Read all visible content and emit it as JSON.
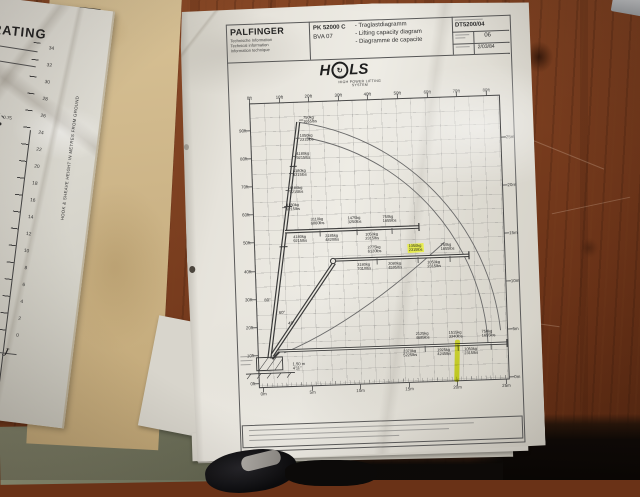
{
  "left_document": {
    "title": "RATING",
    "vertical_axis_label": "HOOK & SHEAVE HEIGHT IN METRES FROM GROUND",
    "axis_numbers": [
      {
        "y": 44,
        "label": "34"
      },
      {
        "y": 61,
        "label": "32"
      },
      {
        "y": 78,
        "label": "30"
      },
      {
        "y": 95,
        "label": "28"
      },
      {
        "y": 112,
        "label": "26"
      },
      {
        "y": 129,
        "label": "24"
      },
      {
        "y": 146,
        "label": "22"
      },
      {
        "y": 163,
        "label": "20"
      },
      {
        "y": 180,
        "label": "18"
      },
      {
        "y": 197,
        "label": "16"
      },
      {
        "y": 214,
        "label": "14"
      },
      {
        "y": 231,
        "label": "12"
      },
      {
        "y": 248,
        "label": "10"
      },
      {
        "y": 265,
        "label": "8"
      },
      {
        "y": 282,
        "label": "6"
      },
      {
        "y": 299,
        "label": "4"
      },
      {
        "y": 316,
        "label": "2"
      },
      {
        "y": 333,
        "label": "0"
      }
    ],
    "point_values": [
      {
        "x": 30,
        "y": 116,
        "label": "0.75"
      },
      {
        "x": 12,
        "y": 190,
        "label": "0.50"
      }
    ],
    "note_fragments": [
      {
        "x": 2,
        "y": 297,
        "label": "t obtained"
      },
      {
        "x": 0,
        "y": 305,
        "label": "y chart is the"
      },
      {
        "x": 0,
        "y": 313,
        "label": "to procure a"
      }
    ],
    "reference": "-1977/6/84",
    "signature": "J"
  },
  "main_document": {
    "header": {
      "brand": "PALFINGER",
      "brand_sub1": "Technische Information",
      "brand_sub2": "Technical information",
      "brand_sub3": "Information technique",
      "model": "PK 52000 C",
      "variant": "BVA 07",
      "title_de": "- Traglastdiagramm",
      "title_en": "- Lifting capacity diagram",
      "title_fr": "- Diagramme de capacite",
      "doc_number": "DT5200/04",
      "sheet_number": "06",
      "issue_date": "2/03/84"
    },
    "logo": {
      "h": "H",
      "ls": "LS",
      "circle_glyph": "↻",
      "max": "MAX",
      "tagline": "HIGH POWER LIFTING SYSTEM"
    },
    "chart": {
      "axes": {
        "top_ft": [
          {
            "x": 68,
            "label": "0ft"
          },
          {
            "x": 98,
            "label": "10ft"
          },
          {
            "x": 127,
            "label": "20ft"
          },
          {
            "x": 157,
            "label": "30ft"
          },
          {
            "x": 186,
            "label": "40ft"
          },
          {
            "x": 216,
            "label": "50ft"
          },
          {
            "x": 246,
            "label": "60ft"
          },
          {
            "x": 275,
            "label": "70ft"
          },
          {
            "x": 305,
            "label": "80ft"
          }
        ],
        "left_ft": [
          {
            "y": 123,
            "label": "90ft"
          },
          {
            "y": 151,
            "label": "80ft"
          },
          {
            "y": 179,
            "label": "70ft"
          },
          {
            "y": 207,
            "label": "60ft"
          },
          {
            "y": 235,
            "label": "50ft"
          },
          {
            "y": 264,
            "label": "40ft"
          },
          {
            "y": 292,
            "label": "30ft"
          },
          {
            "y": 320,
            "label": "20ft"
          },
          {
            "y": 348,
            "label": "10ft"
          },
          {
            "y": 376,
            "label": "0ft"
          }
        ],
        "right_m": [
          {
            "y": 138,
            "label": "25m"
          },
          {
            "y": 186,
            "label": "20m"
          },
          {
            "y": 234,
            "label": "15m"
          },
          {
            "y": 282,
            "label": "10m"
          },
          {
            "y": 330,
            "label": "5m"
          },
          {
            "y": 378,
            "label": "0m"
          }
        ],
        "bottom_m": [
          {
            "x": 72,
            "label": "0m"
          },
          {
            "x": 121,
            "label": "5m"
          },
          {
            "x": 169,
            "label": "10m"
          },
          {
            "x": 218,
            "label": "15m"
          },
          {
            "x": 266,
            "label": "20m"
          },
          {
            "x": 315,
            "label": "25m"
          }
        ]
      },
      "mast_labels": [
        {
          "x": 121,
          "y": 110,
          "kg": "750kg",
          "lbs": "1655lbs"
        },
        {
          "x": 117,
          "y": 128,
          "kg": "1050kg",
          "lbs": "2315lbs"
        },
        {
          "x": 113,
          "y": 146,
          "kg": "4180kg",
          "lbs": "9215lbs"
        },
        {
          "x": 109,
          "y": 163,
          "kg": "4180kg",
          "lbs": "9215lbs"
        },
        {
          "x": 105,
          "y": 180,
          "kg": "4180kg",
          "lbs": "9215lbs"
        },
        {
          "x": 101,
          "y": 197,
          "kg": "4180kg",
          "lbs": "9215lbs"
        }
      ],
      "boom1_above": [
        {
          "x": 125,
          "y": 212,
          "kg": "3110kg",
          "lbs": "6860lbs"
        },
        {
          "x": 162,
          "y": 212,
          "kg": "1475kg",
          "lbs": "3250lbs"
        },
        {
          "x": 197,
          "y": 212,
          "kg": "750kg",
          "lbs": "1655lbs"
        }
      ],
      "boom1_below": [
        {
          "x": 107,
          "y": 229,
          "kg": "4180kg",
          "lbs": "9215lbs"
        },
        {
          "x": 139,
          "y": 229,
          "kg": "2185kg",
          "lbs": "4820lbs"
        },
        {
          "x": 179,
          "y": 229,
          "kg": "1050kg",
          "lbs": "2315lbs"
        }
      ],
      "boom2_above": [
        {
          "x": 181,
          "y": 242,
          "kg": "2775kg",
          "lbs": "6120lbs"
        },
        {
          "x": 222,
          "y": 242,
          "kg": "1050kg",
          "lbs": "2315lbs",
          "highlight": true
        },
        {
          "x": 254,
          "y": 242,
          "kg": "750kg",
          "lbs": "1655lbs"
        }
      ],
      "boom2_below": [
        {
          "x": 170,
          "y": 259,
          "kg": "3180kg",
          "lbs": "7010lbs"
        },
        {
          "x": 201,
          "y": 259,
          "kg": "2080kg",
          "lbs": "4595lbs"
        },
        {
          "x": 240,
          "y": 259,
          "kg": "1050kg",
          "lbs": "2315lbs"
        }
      ],
      "boom3_above": [
        {
          "x": 226,
          "y": 330,
          "kg": "2125kg",
          "lbs": "4685lbs"
        },
        {
          "x": 259,
          "y": 330,
          "kg": "1515kg",
          "lbs": "3340lbs"
        },
        {
          "x": 292,
          "y": 330,
          "kg": "750kg",
          "lbs": "1655lbs"
        }
      ],
      "boom3_below": [
        {
          "x": 213,
          "y": 347,
          "kg": "2370kg",
          "lbs": "5225lbs"
        },
        {
          "x": 247,
          "y": 347,
          "kg": "1925kg",
          "lbs": "4245lbs"
        },
        {
          "x": 274,
          "y": 347,
          "kg": "1050kg",
          "lbs": "2315lbs"
        }
      ],
      "angle_labels": [
        {
          "x": 76,
          "y": 291,
          "label": "80°"
        },
        {
          "x": 90,
          "y": 304,
          "label": "60°"
        },
        {
          "x": 99,
          "y": 315,
          "label": "45°"
        }
      ],
      "base_dimension": {
        "m": "1.50 m",
        "ft": "4'11\""
      },
      "highlight_color": "#e9f02e"
    }
  }
}
